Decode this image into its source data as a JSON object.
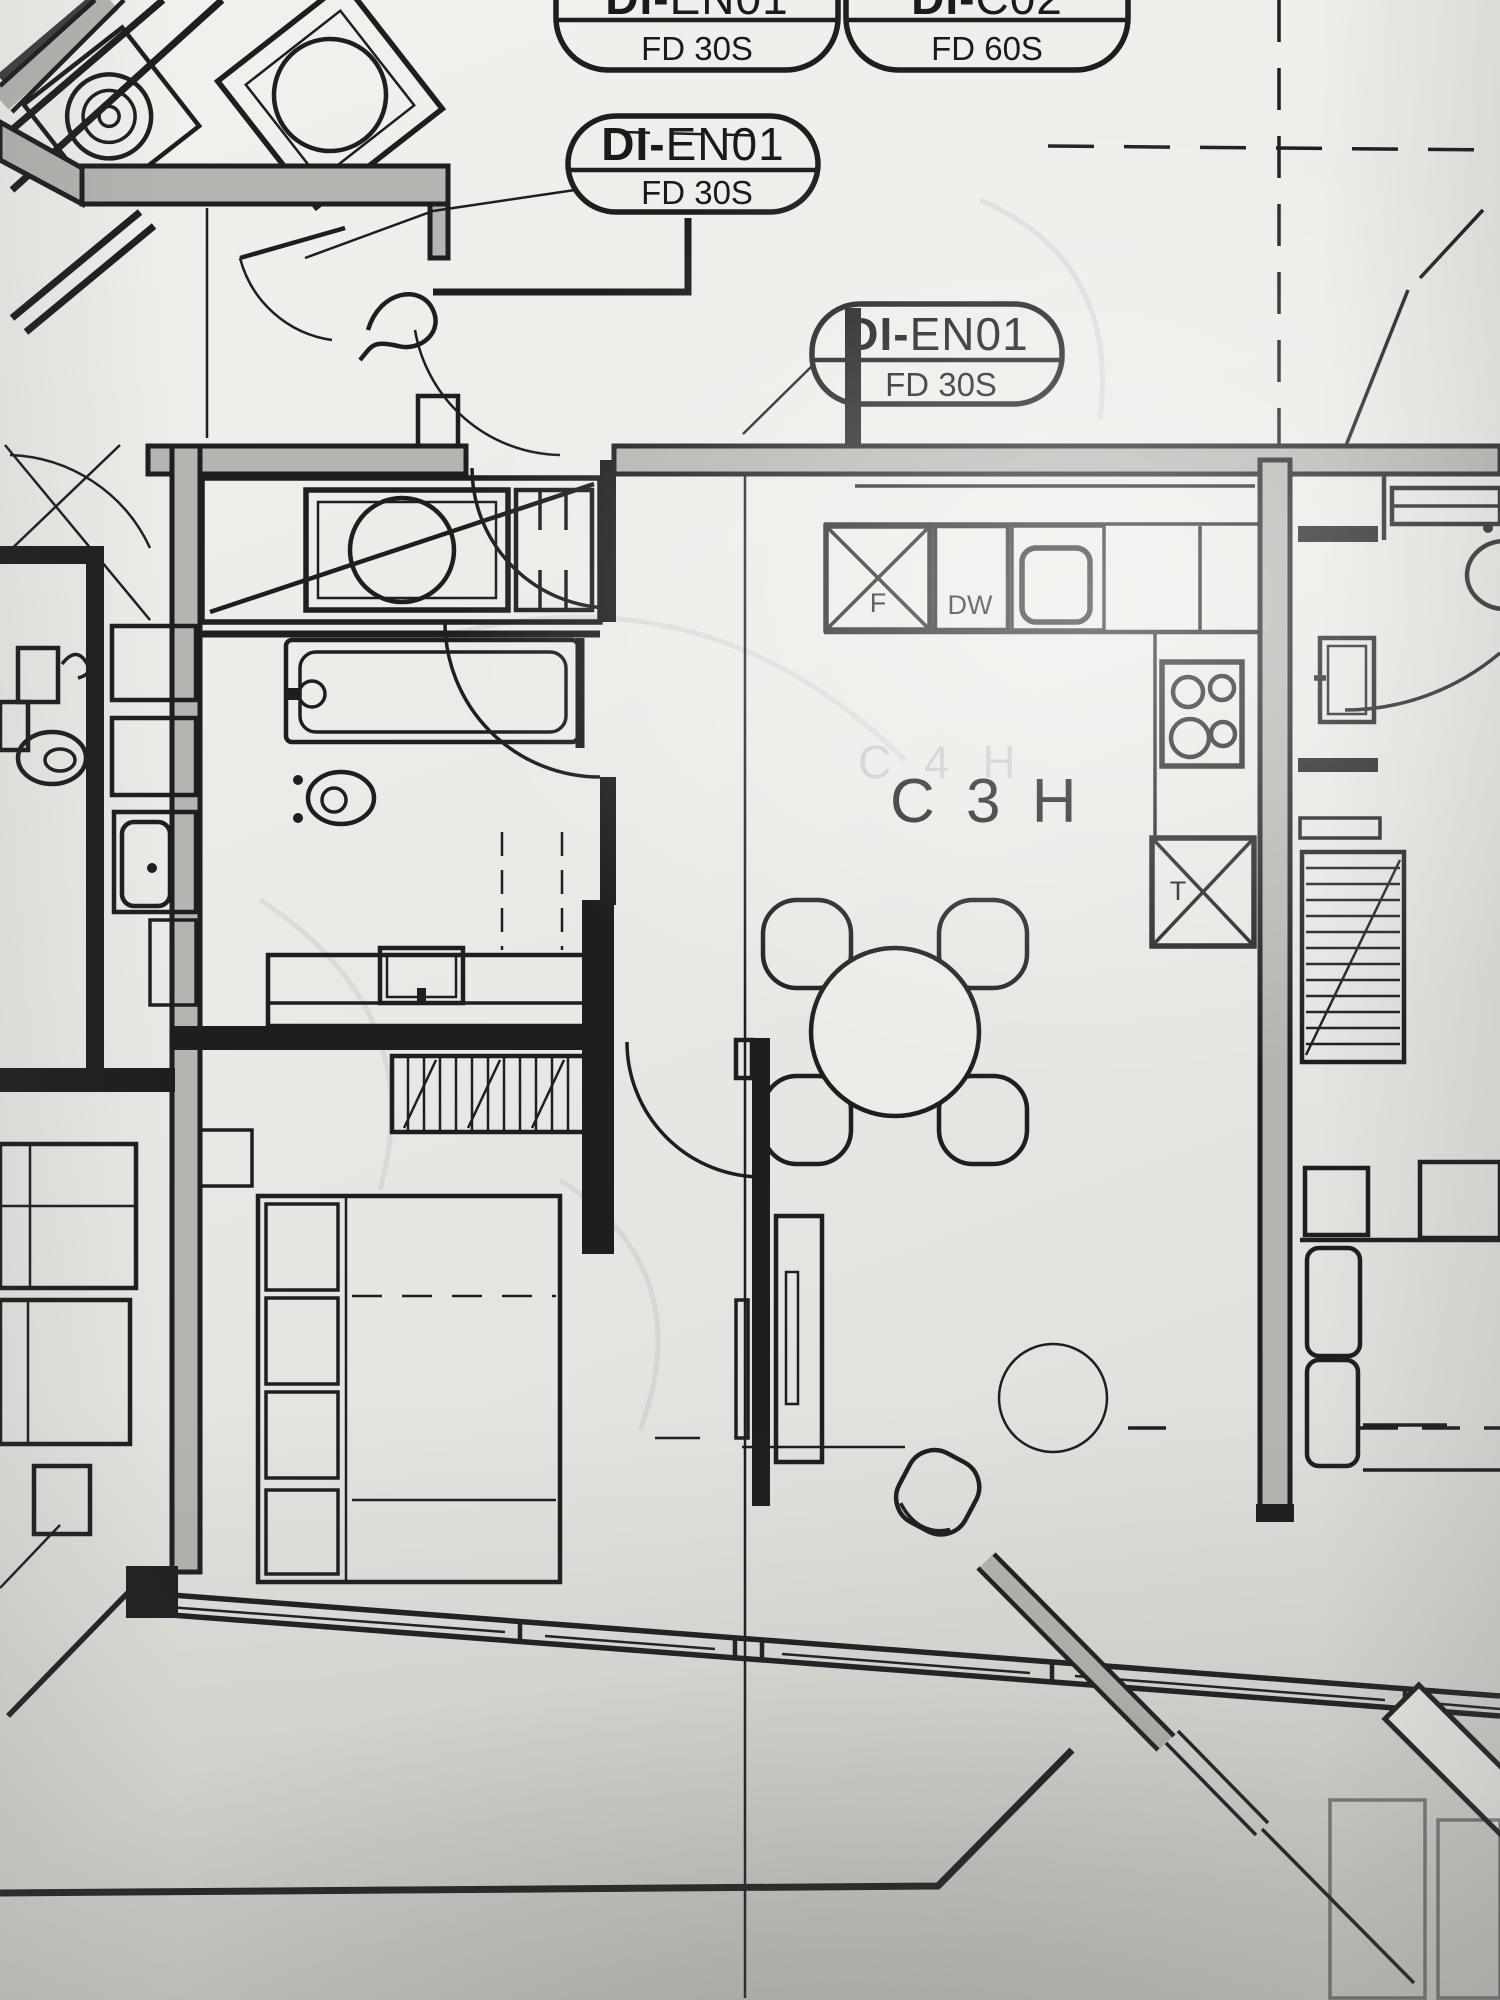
{
  "document": {
    "type": "architectural-floor-plan-photo"
  },
  "unit_label": {
    "text": "C 3 H"
  },
  "ghost_label": {
    "text": "C 4 H"
  },
  "door_tags": {
    "top_left": {
      "code": "DI-EN01",
      "code_prefix": "DI-",
      "code_suffix": "EN01",
      "rating": "FD 30S"
    },
    "top_right": {
      "code": "DI-C02",
      "code_prefix": "DI-",
      "code_suffix": "C02",
      "rating": "FD 60S"
    },
    "corridor": {
      "code": "DI-EN01",
      "code_prefix": "DI-",
      "code_suffix": "EN01",
      "rating": "FD 30S"
    },
    "entry": {
      "code": "DI-EN01",
      "code_prefix": "DI-",
      "code_suffix": "EN01",
      "rating": "FD 30S"
    }
  },
  "appliance_labels": {
    "fridge": "F",
    "dishwasher": "DW",
    "tall_unit": "T"
  },
  "colors": {
    "ink": "#1e1e21",
    "wall_fill": "#b6b4b0",
    "paper": "#ecebe7"
  }
}
